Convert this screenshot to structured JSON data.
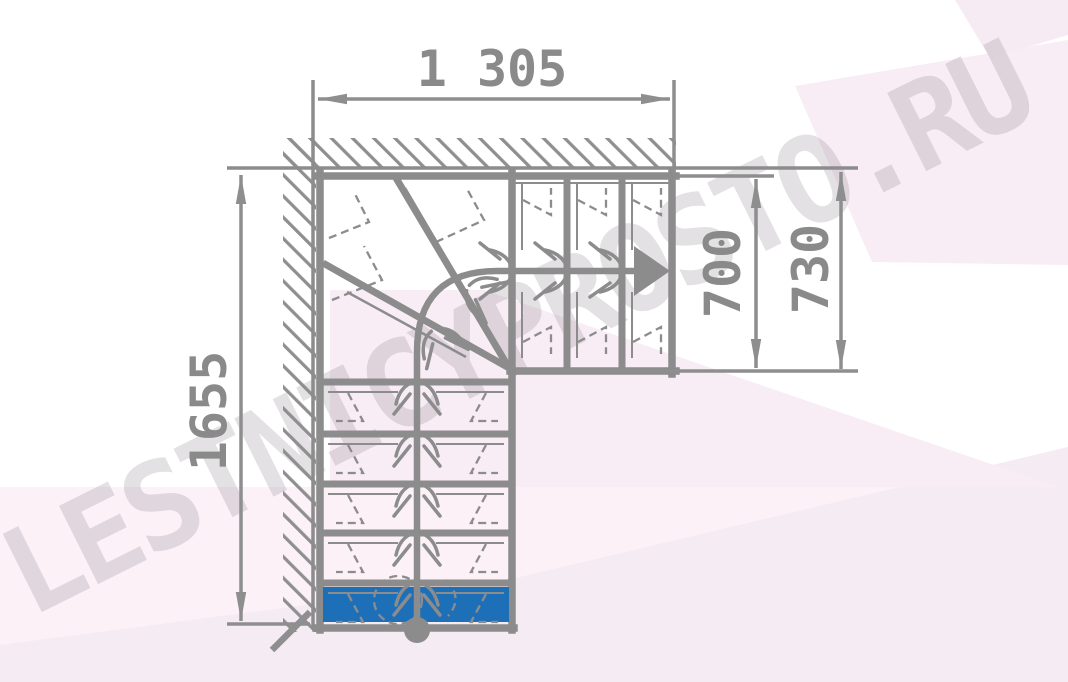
{
  "diagram": {
    "type": "l-shaped-staircase-plan-with-winder-steps",
    "watermark": "LESTNICYPROSTO.RU",
    "dimensions": {
      "total_width": "1 305",
      "upper_flight_width": "700",
      "upper_flight_width_outer": "730",
      "total_length": "1655"
    },
    "counts": {
      "lower_straight_steps": 5,
      "winder_steps": 3,
      "upper_straight_steps": 3
    },
    "colors": {
      "line_gray": "#8c8c8c",
      "dimension_text_gray": "#8a8a8a",
      "first_step_blue": "#1d70b7",
      "background_pink": "#f8edf4",
      "watermark_gray": "#8f848c"
    }
  }
}
